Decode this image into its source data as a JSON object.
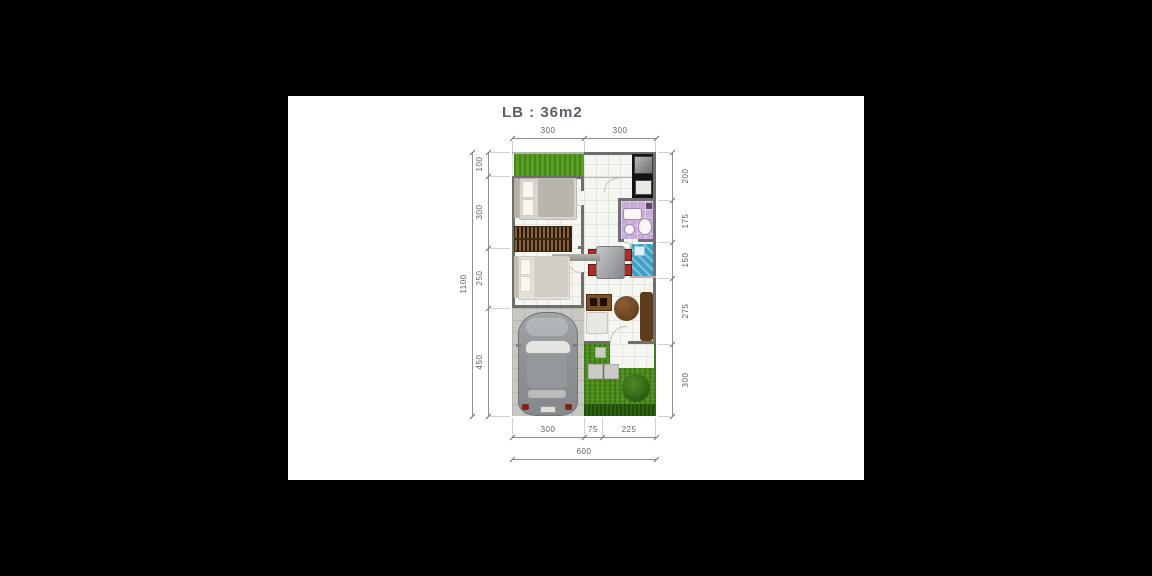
{
  "title": "LB : 36m2",
  "dimensions": {
    "top": [
      "300",
      "300"
    ],
    "bottom_segments": [
      "300",
      "75",
      "225"
    ],
    "bottom_total": "600",
    "left_segments": [
      "100",
      "300",
      "250",
      "450"
    ],
    "left_total": "1100",
    "right_segments": [
      "200",
      "175",
      "150",
      "275",
      "300"
    ]
  },
  "furniture": [
    "garden-grass",
    "front-garden",
    "carport",
    "car",
    "master-bed",
    "second-bed",
    "wardrobe-slats",
    "dining-table",
    "dining-chairs",
    "kitchen-counter",
    "refrigerator",
    "stove",
    "bathroom",
    "bathtub",
    "toilet",
    "sink",
    "wash-area",
    "tv-cabinet",
    "sofa",
    "round-chair",
    "side-bench",
    "stepping-stones",
    "bush",
    "terrace"
  ],
  "colors": {
    "background": "#000000",
    "paper": "#ffffff",
    "title_text": "#5a5f68",
    "dimension_text": "#5f5f5c",
    "wall_gray": "#6f6f6f",
    "grass_green": "#4c8f1d",
    "bathroom_purple": "#c9abd8",
    "water_blue": "#3e9fc4",
    "chair_red": "#b22a20",
    "kitchen_black": "#141414",
    "wood_brown": "#6b4a26",
    "car_gray": "#8f9396"
  }
}
